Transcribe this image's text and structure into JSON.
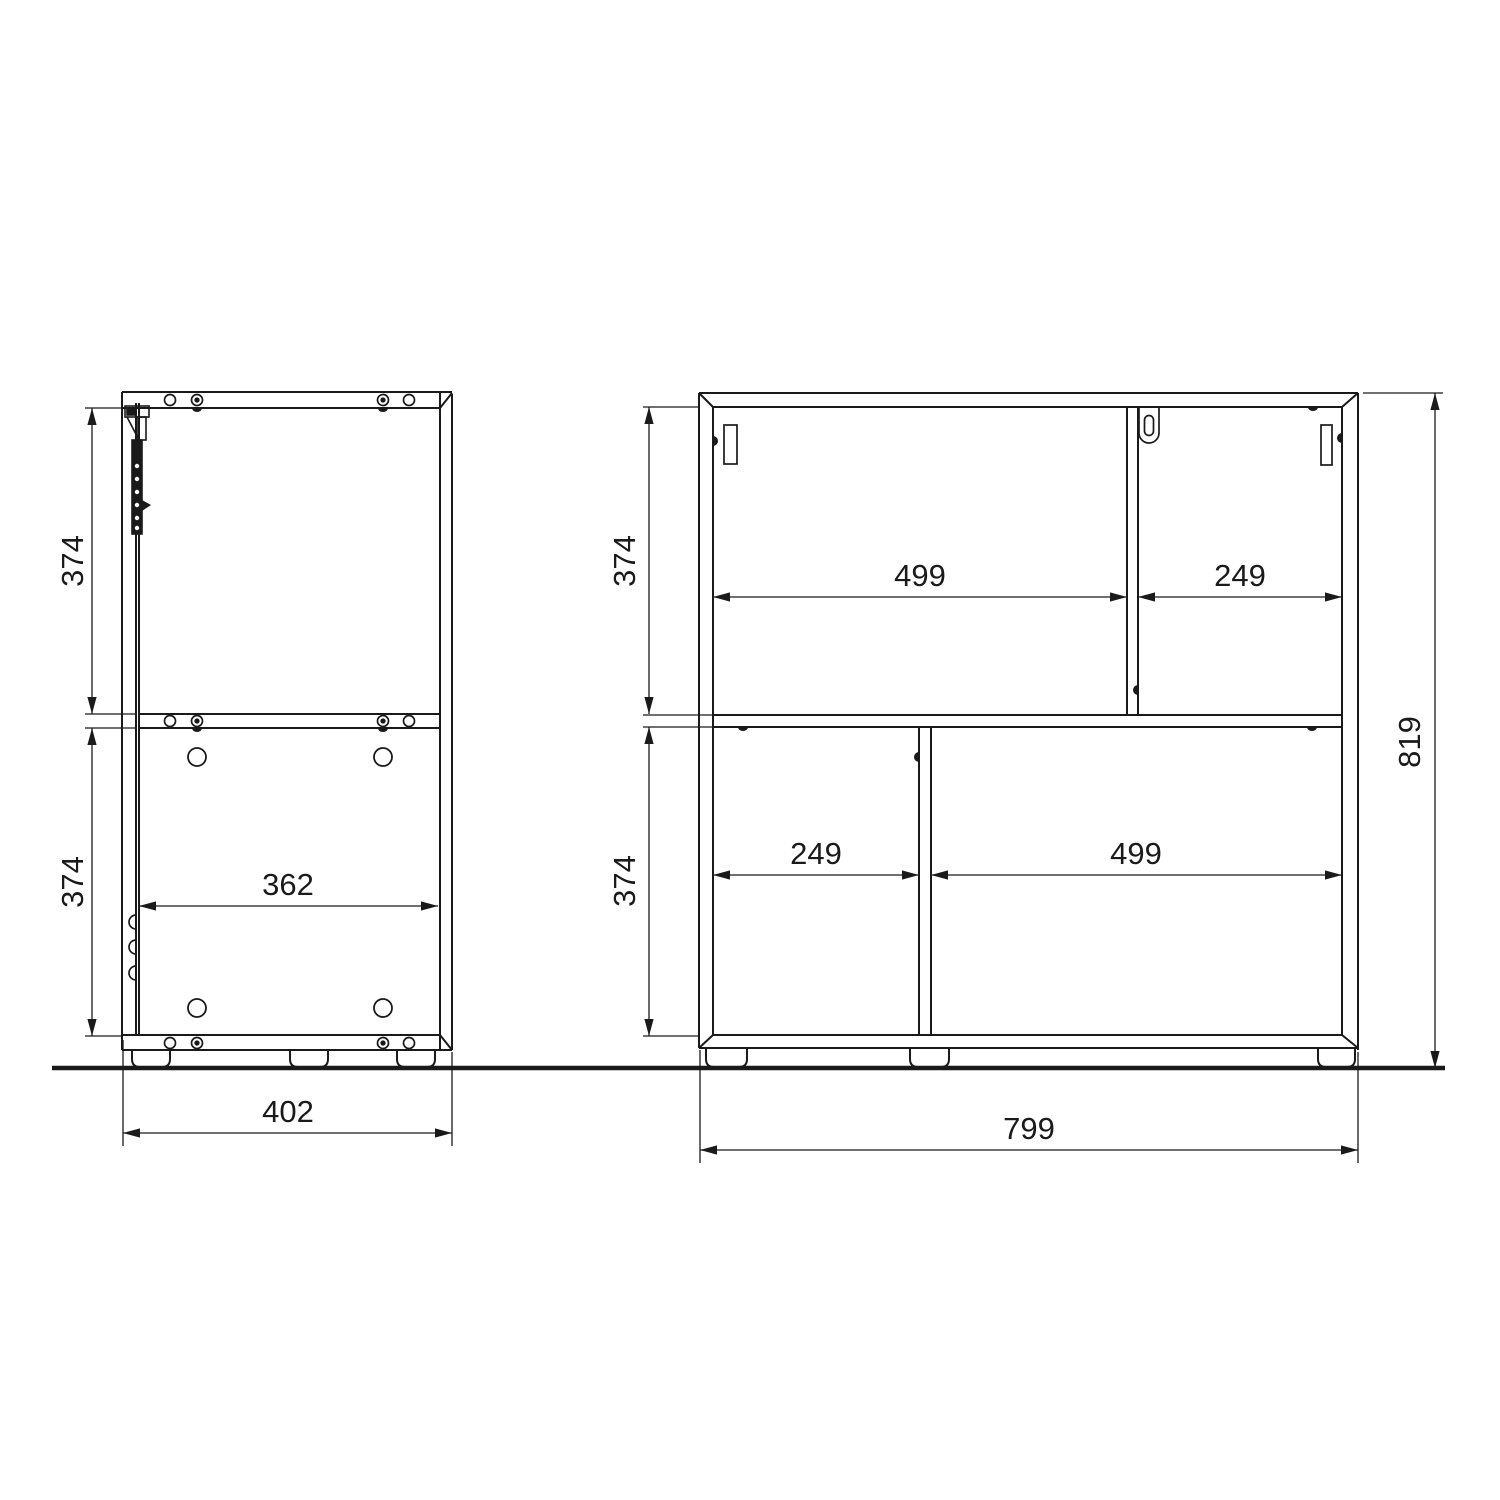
{
  "drawing_title": "cabinet assembly technical drawing",
  "colors": {
    "line": "#1a1a1a",
    "background": "#ffffff"
  },
  "side_view": {
    "dim_top_height": "374",
    "dim_bottom_height": "374",
    "dim_inner_width": "362",
    "dim_overall_width": "402"
  },
  "front_view": {
    "dim_top_height": "374",
    "dim_bottom_height": "374",
    "dim_top_left_width": "499",
    "dim_top_right_width": "249",
    "dim_bottom_left_width": "249",
    "dim_bottom_right_width": "499",
    "dim_overall_height": "819",
    "dim_overall_width": "799"
  }
}
